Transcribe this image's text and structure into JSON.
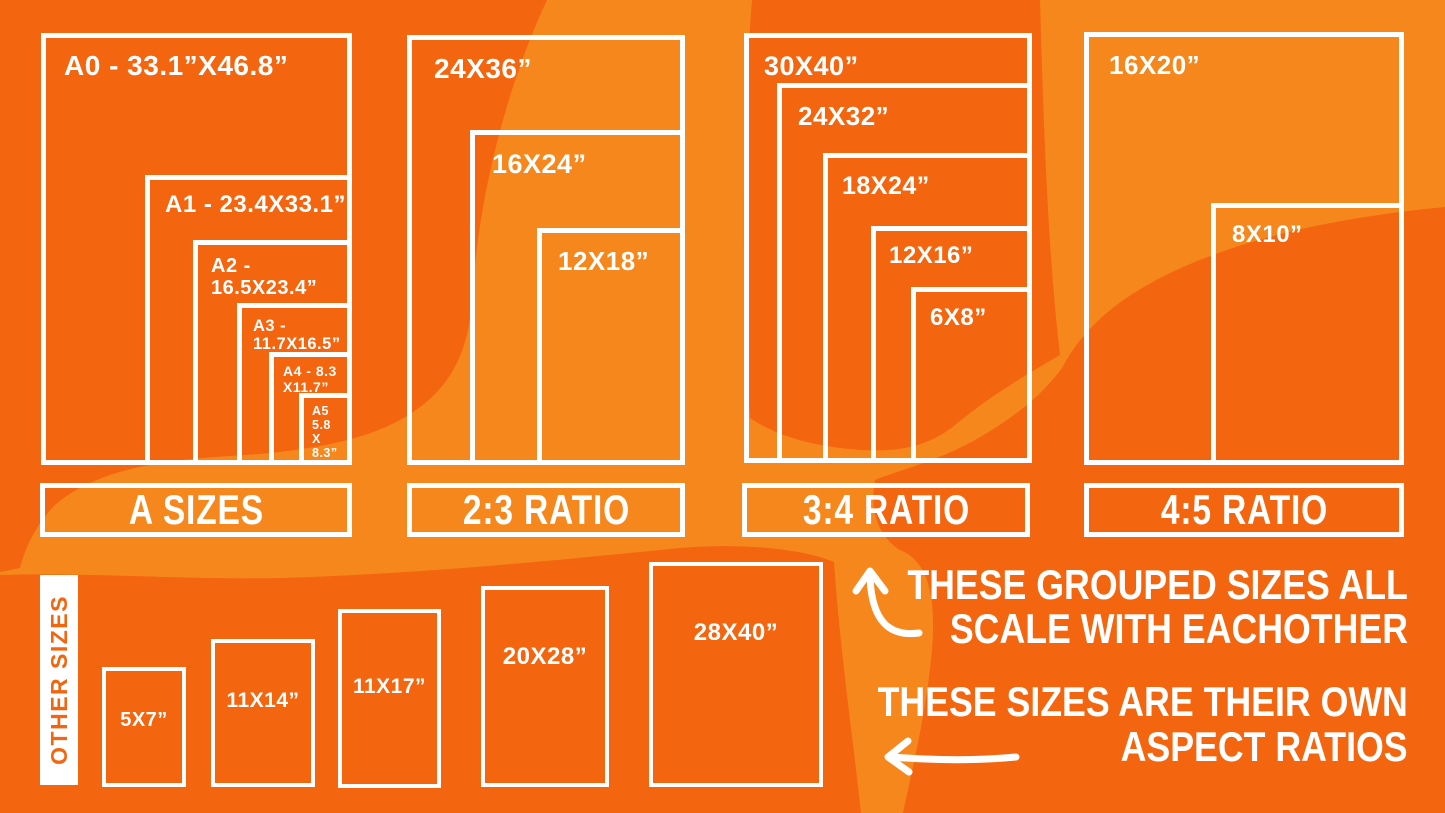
{
  "colors": {
    "background_dark": "#f4650f",
    "background_light": "#f6871c",
    "foreground": "#ffffff"
  },
  "groups": [
    {
      "label": "A SIZES",
      "boxes": [
        {
          "size": "A0 - 33.1”X46.8”"
        },
        {
          "size": "A1 - 23.4X33.1”"
        },
        {
          "size": "A2 - 16.5X23.4”"
        },
        {
          "size": "A3 - 11.7X16.5”"
        },
        {
          "size": "A4 - 8.3\nX11.7”"
        },
        {
          "size": "A5\n5.8\nX\n8.3”"
        }
      ]
    },
    {
      "label": "2:3 RATIO",
      "boxes": [
        {
          "size": "24X36”"
        },
        {
          "size": "16X24”"
        },
        {
          "size": "12X18”"
        }
      ]
    },
    {
      "label": "3:4 RATIO",
      "boxes": [
        {
          "size": "30X40”"
        },
        {
          "size": "24X32”"
        },
        {
          "size": "18X24”"
        },
        {
          "size": "12X16”"
        },
        {
          "size": "6X8”"
        }
      ]
    },
    {
      "label": "4:5 RATIO",
      "boxes": [
        {
          "size": "16X20”"
        },
        {
          "size": "8X10”"
        }
      ]
    }
  ],
  "other_sizes": {
    "label": "OTHER SIZES",
    "boxes": [
      {
        "size": "5X7”"
      },
      {
        "size": "11X14”"
      },
      {
        "size": "11X17”"
      },
      {
        "size": "20X28”"
      },
      {
        "size": "28X40”"
      }
    ]
  },
  "annotations": {
    "grouped_scale_line1": "THESE GROUPED SIZES ALL",
    "grouped_scale_line2": "SCALE WITH EACHOTHER",
    "own_ratio_line1": "THESE SIZES ARE THEIR OWN",
    "own_ratio_line2": "ASPECT RATIOS"
  }
}
